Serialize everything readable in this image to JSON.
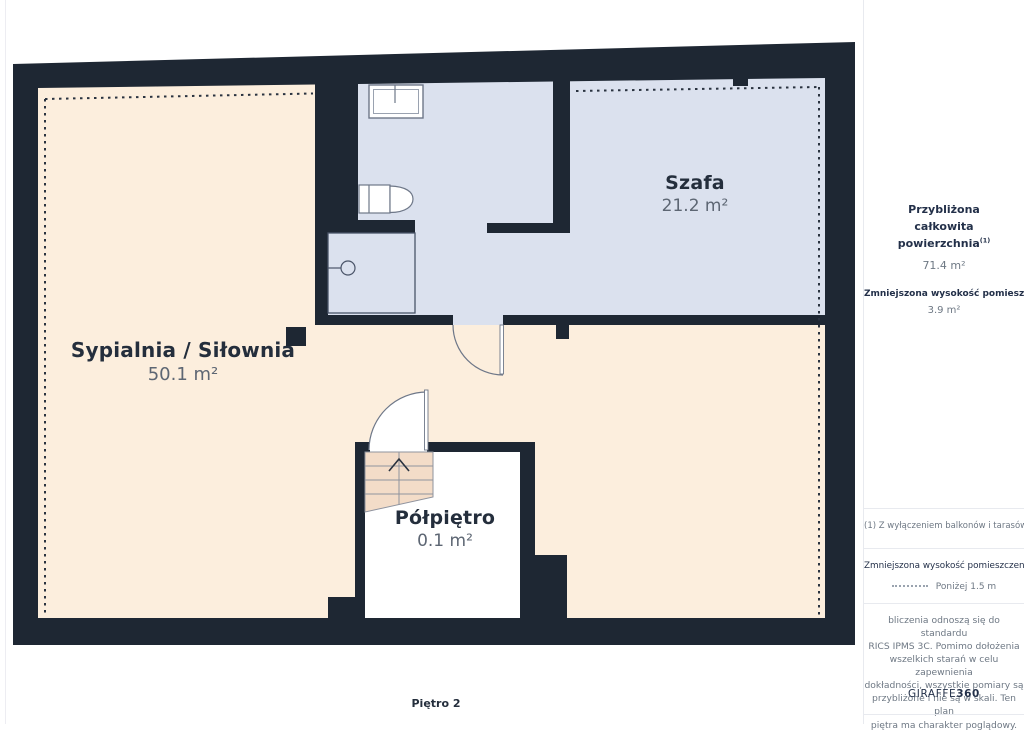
{
  "plan": {
    "floor_label": "Piętro 2",
    "rooms": [
      {
        "name": "Sypialnia / Siłownia",
        "area": "50.1 m²"
      },
      {
        "name": "Szafa",
        "area": "21.2 m²"
      },
      {
        "name": "Półpiętro",
        "area": "0.1 m²"
      }
    ]
  },
  "sidebar": {
    "total_area_label": "Przybliżona całkowita powierzchnia",
    "total_area_note_marker": "(1)",
    "total_area_value": "71.4 m²",
    "reduced_height_label": "Zmniejszona wysokość pomieszczenia",
    "reduced_height_value": "3.9 m²",
    "footnote": "(1) Z wyłączeniem balkonów i tarasów",
    "legend_reduced_height_label": "Zmniejszona wysokość pomieszczenia",
    "legend_reduced_height_value": "Poniżej 1.5 m",
    "disclaimer_lines": [
      "bliczenia odnoszą się do standardu",
      "RICS IPMS 3C. Pomimo dołożenia",
      "wszelkich starań w celu zapewnienia",
      "dokładności, wszystkie pomiary są",
      "przybliżone i nie są w skali. Ten plan",
      "piętra ma charakter poglądowy."
    ],
    "brand_regular": "GIRAFFE",
    "brand_bold": "360"
  },
  "colors": {
    "wall": "#1e2733",
    "room_warm": "#fceedd",
    "room_cool": "#dbe1ee",
    "stairs": "#f3dcc8",
    "text_dark": "#242e3c",
    "text_gray": "#5d6673"
  }
}
